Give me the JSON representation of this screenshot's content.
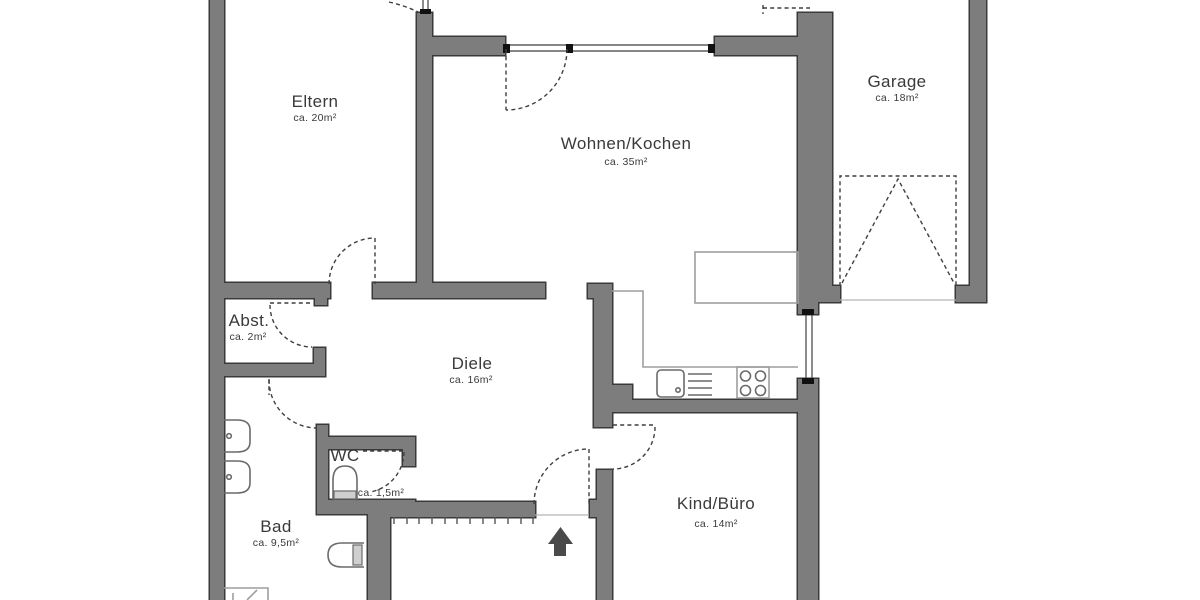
{
  "plan": {
    "type": "floor-plan",
    "colors": {
      "wall_fill": "#7d7d7d",
      "wall_outline": "#3a3a3a",
      "label": "#3a3a3a",
      "fixture_outline": "#6a6a6a",
      "counter_outline": "#9e9e9e",
      "entrance_arrow": "#4a4a4a",
      "background": "#ffffff"
    },
    "rooms": [
      {
        "id": "eltern",
        "name": "Eltern",
        "area": "ca. 20m²"
      },
      {
        "id": "wohnen-kochen",
        "name": "Wohnen/Kochen",
        "area": "ca. 35m²"
      },
      {
        "id": "garage",
        "name": "Garage",
        "area": "ca. 18m²"
      },
      {
        "id": "abstellraum",
        "name": "Abst.",
        "area": "ca. 2m²"
      },
      {
        "id": "diele",
        "name": "Diele",
        "area": "ca. 16m²"
      },
      {
        "id": "wc",
        "name": "WC",
        "area": "ca. 1,5m²"
      },
      {
        "id": "bad",
        "name": "Bad",
        "area": "ca. 9,5m²"
      },
      {
        "id": "kind-buero",
        "name": "Kind/Büro",
        "area": "ca. 14m²"
      }
    ],
    "symbols": {
      "entrance_arrow": "up-arrow",
      "garage_door": "sectional-door-dashed",
      "doors": "dashed-quarter-arc-swings",
      "windows": "double-line-glazing"
    }
  }
}
